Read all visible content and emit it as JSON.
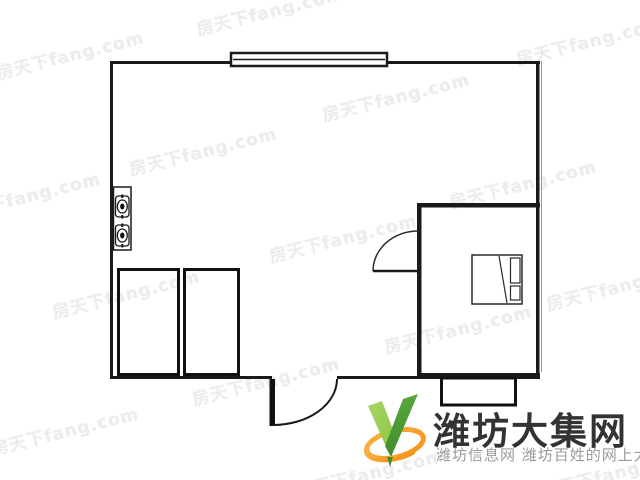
{
  "page": {
    "width": 640,
    "height": 480,
    "background": "#ffffff"
  },
  "watermark": {
    "text": "房天下fang.com",
    "color": "#ececec",
    "positions": [
      [
        70,
        54
      ],
      [
        270,
        10
      ],
      [
        590,
        40
      ],
      [
        203,
        150
      ],
      [
        396,
        96
      ],
      [
        27,
        195
      ],
      [
        523,
        183
      ],
      [
        126,
        293
      ],
      [
        343,
        237
      ],
      [
        620,
        285
      ],
      [
        266,
        380
      ],
      [
        458,
        328
      ],
      [
        65,
        430
      ],
      [
        370,
        472
      ],
      [
        615,
        472
      ]
    ]
  },
  "floorplan": {
    "wall_color": "#1a1a1a",
    "features": [
      "outer walls",
      "top window",
      "gas stove with two burners",
      "two wardrobes",
      "entry door with swing arc",
      "bedroom with door swing arc",
      "bed with pillows",
      "bottom bay window"
    ]
  },
  "logo": {
    "title": "潍坊大集网",
    "subtitle": "潍坊信息网 潍坊百姓的网上大集",
    "title_color": "#333333",
    "subtitle_color": "#9b9b9b",
    "check_green_light": "#8dc63f",
    "check_green_dark": "#3f8f2e",
    "ring_orange": "#f7941d"
  }
}
